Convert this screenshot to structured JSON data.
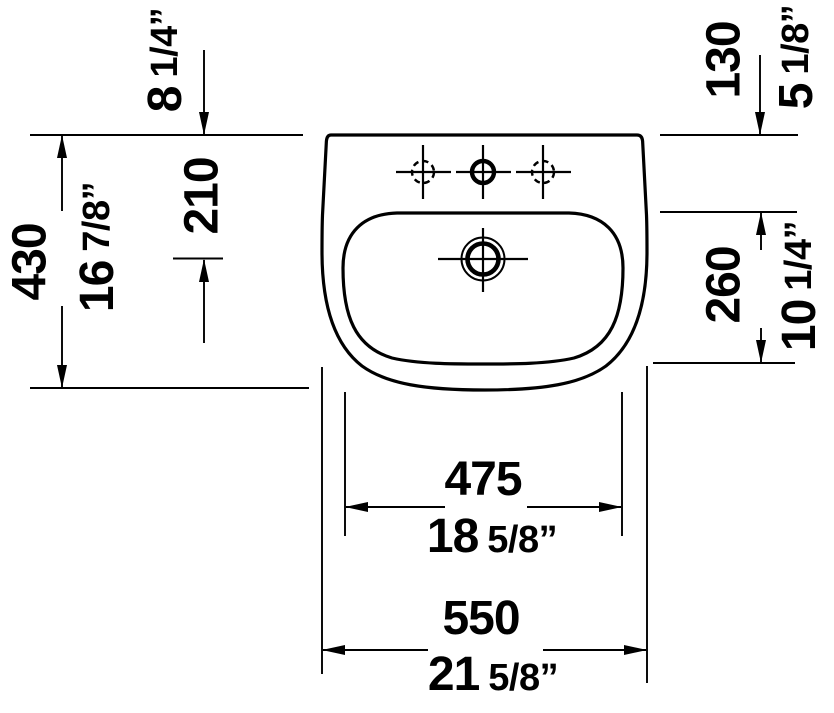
{
  "drawing": {
    "background_color": "#ffffff",
    "line_color": "#000000"
  },
  "dimensions": {
    "overall_width": {
      "mm": "550",
      "inch_main": "21",
      "inch_frac": "5/8”"
    },
    "basin_width": {
      "mm": "475",
      "inch_main": "18",
      "inch_frac": "5/8”"
    },
    "overall_depth": {
      "mm": "430",
      "inch_main": "16",
      "inch_frac": "7/8”"
    },
    "back_to_drain": {
      "mm": "210",
      "inch_main": "8",
      "inch_frac": "1/4”"
    },
    "back_ledge_depth": {
      "mm": "130",
      "inch_main": "5",
      "inch_frac": "1/8”"
    },
    "basin_depth": {
      "mm": "260",
      "inch_main": "10",
      "inch_frac": "1/4”"
    }
  }
}
